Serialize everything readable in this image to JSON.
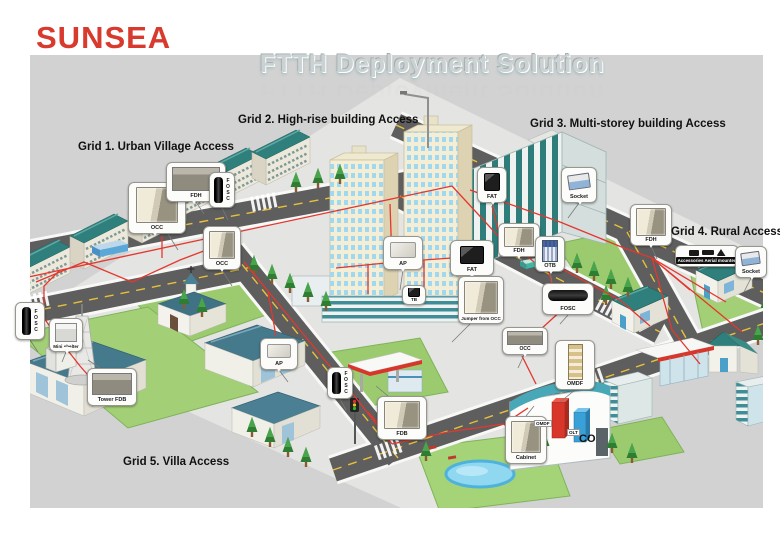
{
  "logo": {
    "text": "SUNSEA"
  },
  "title": {
    "text": "FTTH Deployment Solution"
  },
  "grids": [
    {
      "label": "Grid 1. Urban Village Access"
    },
    {
      "label": "Grid 2. High-rise building Access"
    },
    {
      "label": "Grid 3. Multi-storey building Access"
    },
    {
      "label": "Grid 4. Rural Access"
    },
    {
      "label": "Grid 5. Villa Access"
    }
  ],
  "callouts": [
    {
      "id": "occ-1",
      "label": "OCC"
    },
    {
      "id": "fdh-1",
      "label": "FDH"
    },
    {
      "id": "fosc-1",
      "label": "FOSC"
    },
    {
      "id": "occ-2",
      "label": "OCC"
    },
    {
      "id": "ap-1",
      "label": "AP"
    },
    {
      "id": "fat-1",
      "label": "FAT"
    },
    {
      "id": "tb",
      "label": "TB"
    },
    {
      "id": "jumper-from-occ",
      "label": "Jumper from OCC"
    },
    {
      "id": "fat-2",
      "label": "FAT"
    },
    {
      "id": "socket-1",
      "label": "Socket"
    },
    {
      "id": "fdh-2",
      "label": "FDH"
    },
    {
      "id": "otb",
      "label": "OTB"
    },
    {
      "id": "fosc-2",
      "label": "FOSC"
    },
    {
      "id": "fdh-3",
      "label": "FDH"
    },
    {
      "id": "accessories",
      "label": "Accessories Aerial mounted"
    },
    {
      "id": "socket-2",
      "label": "Socket"
    },
    {
      "id": "fosc-3",
      "label": "FOSC"
    },
    {
      "id": "mini-shelter",
      "label": "Mini shelter"
    },
    {
      "id": "tower-fdb",
      "label": "Tower FDB"
    },
    {
      "id": "ap-2",
      "label": "AP"
    },
    {
      "id": "fosc-4",
      "label": "FOSC"
    },
    {
      "id": "fdb",
      "label": "FDB"
    },
    {
      "id": "occ-3",
      "label": "OCC"
    },
    {
      "id": "omdf",
      "label": "OMDF"
    },
    {
      "id": "cabinet",
      "label": "Cabinet"
    }
  ],
  "central_office": {
    "label": "CO",
    "olt_label": "OLT",
    "omdf_label": "OMDF"
  },
  "colors": {
    "background_gray": "#d2d2d2",
    "logo_red": "#d93a2e",
    "cable_red": "#e4372e",
    "roof_teal": "#2f7f7c",
    "villa_roof_blue": "#45798c",
    "road_gray": "#5e5e5e",
    "grass_green": "#9ccb6f",
    "pond_blue": "#8fd8f0",
    "olt_bar_blue": "#3aa0d8",
    "omdf_bar_red": "#d8352b",
    "title_silver": "#ccd2d3"
  }
}
